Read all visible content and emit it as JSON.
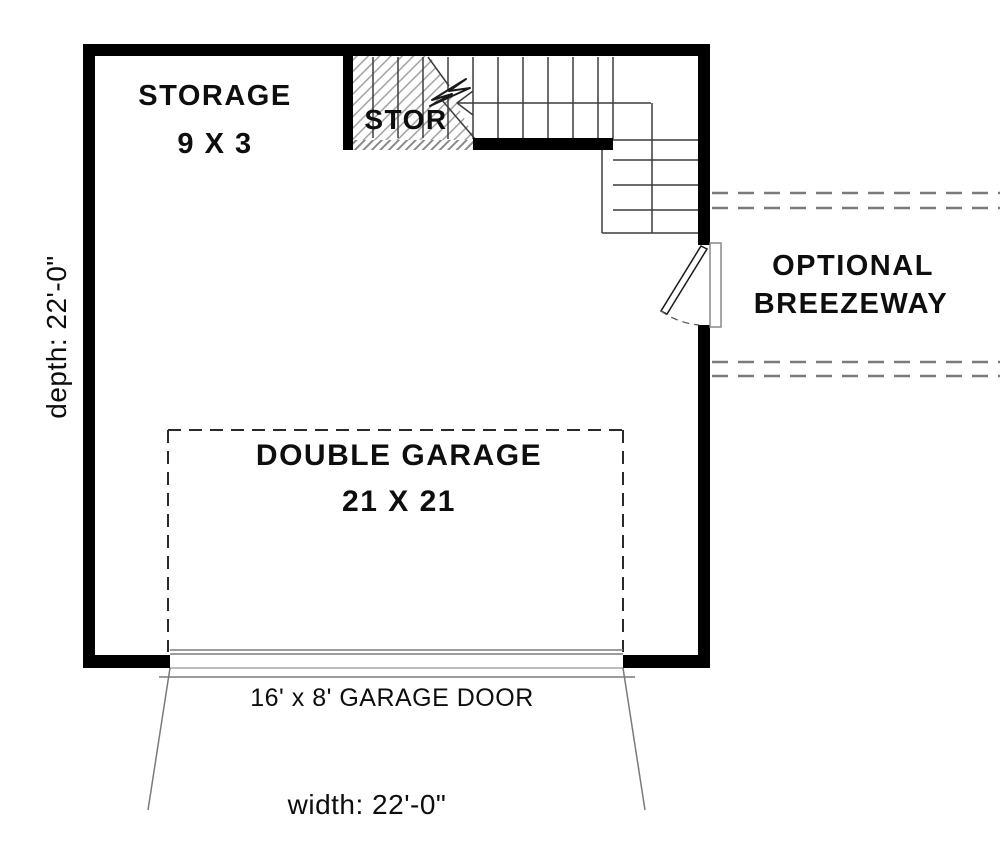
{
  "plan_title": "garage floor plan",
  "rooms": {
    "storage": {
      "label": "STORAGE",
      "size": "9 X 3"
    },
    "stair_storage": {
      "label": "STOR"
    },
    "garage": {
      "label": "DOUBLE GARAGE",
      "size": "21 X 21"
    }
  },
  "annotations": {
    "breezeway": {
      "line1": "OPTIONAL",
      "line2": "BREEZEWAY"
    },
    "garage_door": {
      "label": "16' x 8' GARAGE DOOR"
    },
    "dimensions": {
      "width": "width: 22'-0\"",
      "depth": "depth: 22'-0\""
    }
  },
  "icons": {
    "stair_direction_arrow": "hand-drawn left arrow on stair run",
    "door_swing": "quarter-circle dashed swing arc"
  },
  "colors": {
    "wall": "#000000",
    "stair_line": "#3c3c3c",
    "gray_line": "#7a7a7a",
    "dashed_outline": "#2a2a2a",
    "hatch": "#9a9a9a",
    "background": "#ffffff"
  }
}
